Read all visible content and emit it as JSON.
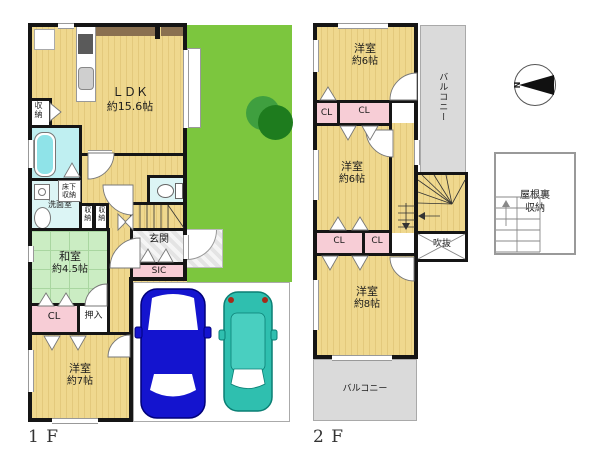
{
  "floor1": {
    "floor_label": "1 F",
    "ldk": {
      "name": "ＬＤＫ",
      "size": "約15.6帖"
    },
    "japanese_room": {
      "name": "和室",
      "size": "約4.5帖"
    },
    "western_room_7": {
      "name": "洋室",
      "size": "約7帖"
    },
    "entrance": "玄関",
    "sic": "SIC",
    "closet": "CL",
    "oshiire": "押入",
    "storage": "収納",
    "underfloor_storage": "床下収納",
    "washroom": "洗面室"
  },
  "floor2": {
    "floor_label": "2 F",
    "western_room_6_north": {
      "name": "洋室",
      "size": "約6帖"
    },
    "western_room_6_mid": {
      "name": "洋室",
      "size": "約6帖"
    },
    "western_room_8": {
      "name": "洋室",
      "size": "約8帖"
    },
    "closet_a": "CL",
    "closet_b": "CL",
    "closet_c": "CL",
    "closet_d": "CL",
    "balcony_north": "バルコニー",
    "balcony_south": "バルコニー",
    "void": "吹抜",
    "attic_storage": "屋根裏収納"
  },
  "compass": {
    "north_label": "N"
  },
  "palette": {
    "floor_yellow": "#EFD88E",
    "wall_black": "#151515",
    "tatami_green": "#CBEDC3",
    "closet_pink": "#F7CDD6",
    "bathroom_cyan": "#BFEFF1",
    "yard_green": "#7CC63E",
    "tree_green": "#2E8F2E",
    "balcony_gray": "#DADADA",
    "car_blue": "#1414CF",
    "car_teal": "#2FBFAF"
  }
}
